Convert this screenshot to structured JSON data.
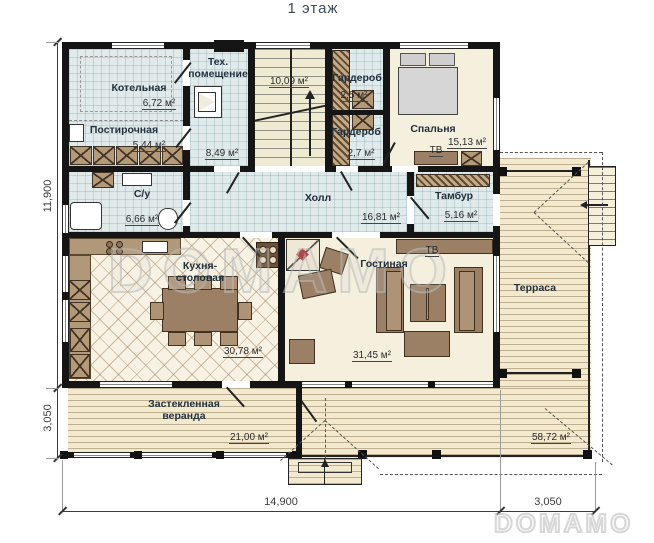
{
  "title": "1 этаж",
  "watermark": "DOMAMO",
  "logo": "DOMAMO",
  "labels": {
    "tv": "ТВ"
  },
  "rooms": {
    "kotelnaya": {
      "name": "Котельная",
      "area": "6,72 м²"
    },
    "tech": {
      "name": "Тех. помещение",
      "area": "8,49 м²"
    },
    "stairs": {
      "area": "10,09 м²"
    },
    "postirochnaya": {
      "name": "Постирочная",
      "area": "5,44 м²"
    },
    "wardrobe1": {
      "name": "Гардероб",
      "area": "2,5 м²"
    },
    "wardrobe2": {
      "name": "Гардероб",
      "area": "2,7 м²"
    },
    "bedroom": {
      "name": "Спальня",
      "area": "15,13 м²"
    },
    "su": {
      "name": "С/у",
      "area": "6,66 м²"
    },
    "hall": {
      "name": "Холл",
      "area": "16,81 м²"
    },
    "tambur": {
      "name": "Тамбур",
      "area": "5,16 м²"
    },
    "kitchen": {
      "name": "Кухня-столовая",
      "area": "30,78 м²"
    },
    "living": {
      "name": "Гостиная",
      "area": "31,45 м²"
    },
    "terrace": {
      "name": "Терраса",
      "area": "58,72 м²"
    },
    "veranda": {
      "name": "Застекленная веранда",
      "area": "21,00 м²"
    }
  },
  "dimensions": {
    "left_main": "11,900",
    "left_veranda": "3,050",
    "bottom_main": "14,900",
    "bottom_terrace": "3,050"
  }
}
